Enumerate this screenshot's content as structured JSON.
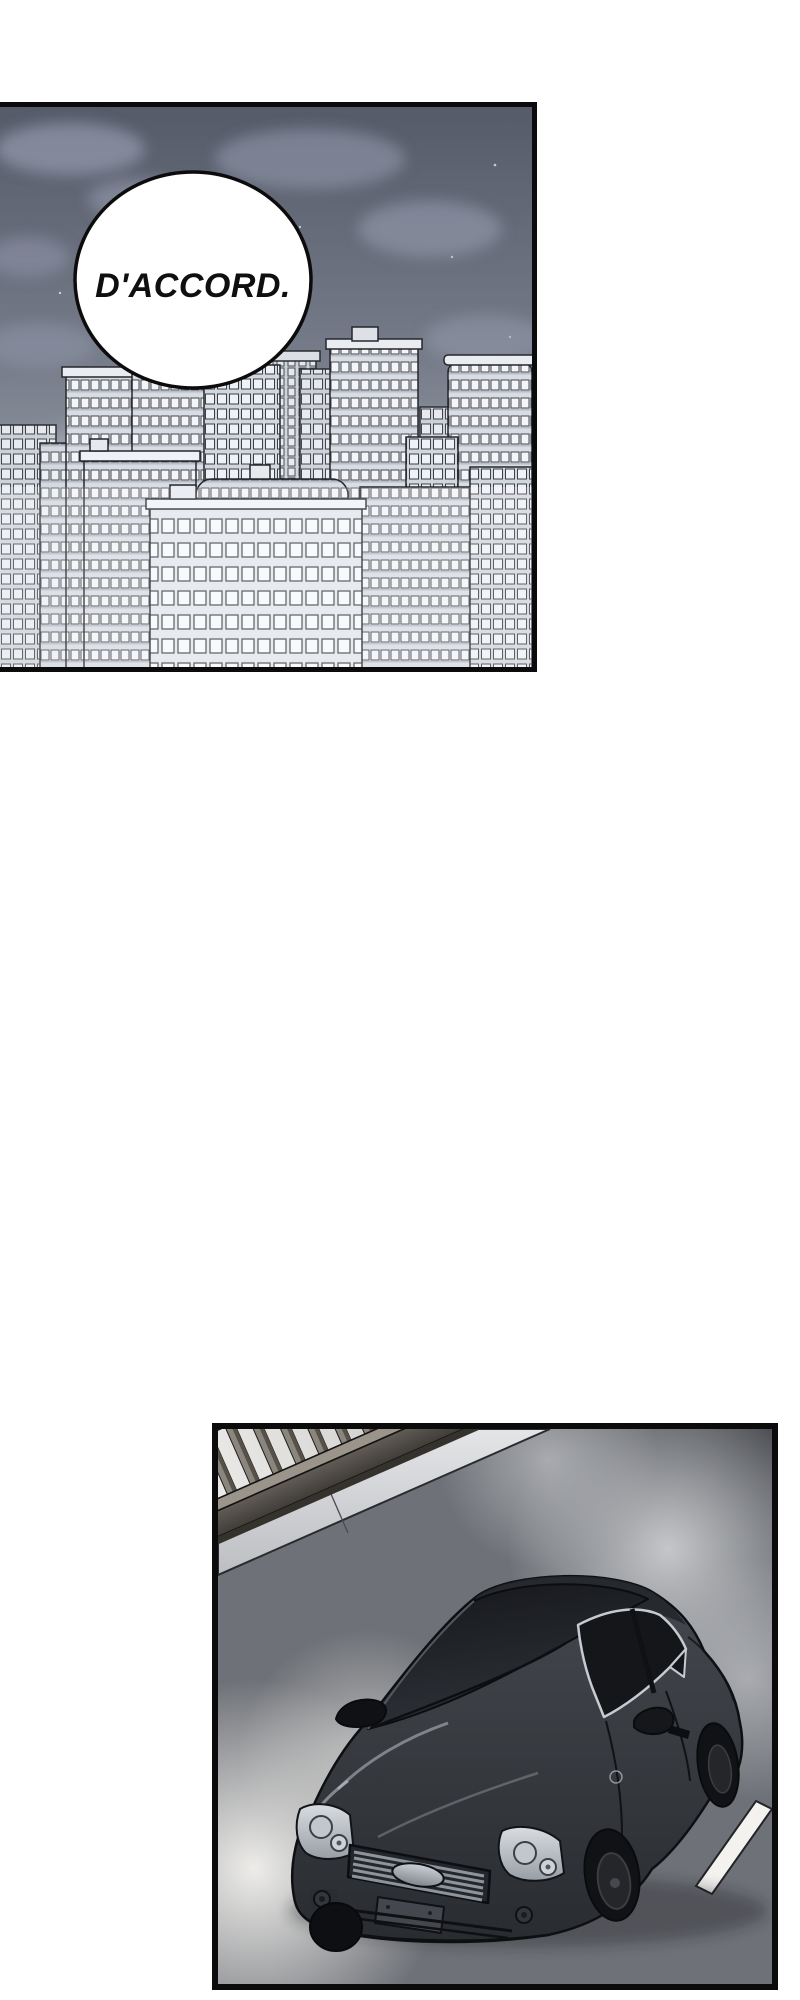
{
  "page": {
    "kind": "webtoon comic page",
    "background_color": "#ffffff",
    "width_px": 800,
    "height_px": 2000
  },
  "panel_city": {
    "description": "Night city skyline of pale high-rise buildings under a dark cloudy sky",
    "speech_bubble": {
      "text": "D'ACCORD."
    },
    "colors": {
      "sky_top": "#555b69",
      "sky_bottom": "#a6abb5",
      "cloud": "#9197a9",
      "building_fill": "#e9edf2",
      "building_outline": "#24262b",
      "bubble_fill": "#ffffff",
      "bubble_outline": "#0c0c0c"
    }
  },
  "panel_street": {
    "description": "Black sedan driving at night on a bridge road beside a guard railing and sidewalk",
    "colors": {
      "road": "#6e7177",
      "road_glow": "#ebeae7",
      "sidewalk": "#d9dadc",
      "railing_light": "#8a857d",
      "railing_dark": "#474340",
      "car_body": "#383b41",
      "car_window": "#15171b",
      "window_frame": "#c6cbd1",
      "lane_marking": "#f3f2ef",
      "headlight": "#ccd1d7"
    }
  }
}
